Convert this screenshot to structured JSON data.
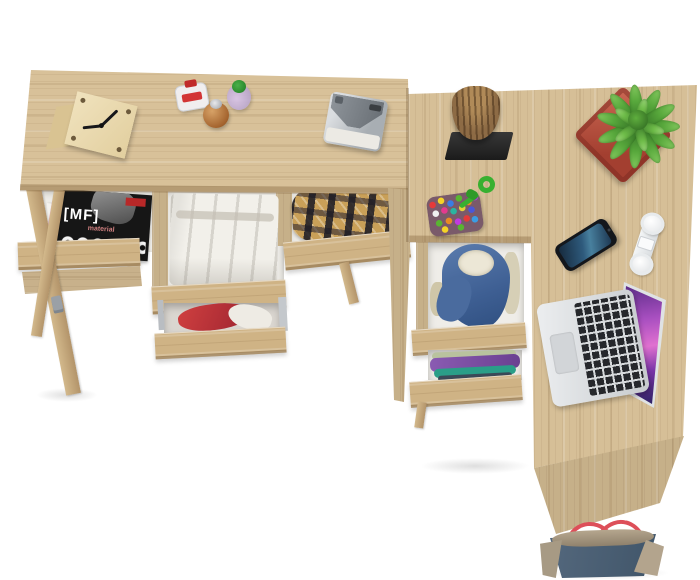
{
  "meta": {
    "type": "product-photo",
    "subject": "Top-down view of an L-shaped light oak desk with open drawers filled with clothes and magazines, styled with desk accessories",
    "background_color": "#ffffff"
  },
  "palette": {
    "wood_light": "#d8c199",
    "wood_mid": "#cfb385",
    "wood_dark_edge": "#a98c5f",
    "drawer_interior": "#efede8",
    "magazine_black": "#161616",
    "magazine_pink": "#e8a8bc",
    "plaid_tan": "#c9a058",
    "denim_blue": "#4a6fa0",
    "sherpa_white": "#ece7d6",
    "purple_cloth": "#7b4fa0",
    "teal_cloth": "#2a9e88",
    "red_cloth": "#c23535",
    "plant_pot_red": "#b44c3d",
    "plant_green": "#58a83c",
    "log_brown": "#8d6b45",
    "log_base_black": "#242424",
    "cord_green": "#38b030",
    "phone_screen_blue": "#2e5a7c",
    "laptop_silver": "#dcdee0",
    "laptop_screen_purple": "#a84fc0",
    "headphones_white": "#eef0f2",
    "bag_denim": "#4d6177",
    "bag_canvas": "#a89a84",
    "bag_strap_red": "#dd4f59"
  },
  "magazine": {
    "title": "[MF]",
    "subtitle": "material"
  },
  "desk": {
    "left_section": {
      "label": "writing desk with three open drawers and X-legs",
      "drawer_contents": [
        "music magazines and CDs",
        "white folded clothes",
        "brown plaid shirt"
      ],
      "lower_drawer_contents": "red and white clothes",
      "surface_items": [
        "wooden cube clock",
        "red-cap perfume bottle",
        "amber perfume bottle",
        "green-cap perfume bottle",
        "silver instant camera"
      ]
    },
    "right_section": {
      "label": "desk return with two-drawer pedestal",
      "drawer_contents": [
        "denim jacket with sherpa lining",
        "folded purple and teal clothes"
      ],
      "surface_items": [
        "log sculpture on black base",
        "multicolor bead charm with green cord",
        "green plant in red square pot",
        "smartphone",
        "white folded headphones",
        "open silver laptop"
      ]
    },
    "floor_items": [
      "blue canvas tote bag with red straps"
    ]
  }
}
